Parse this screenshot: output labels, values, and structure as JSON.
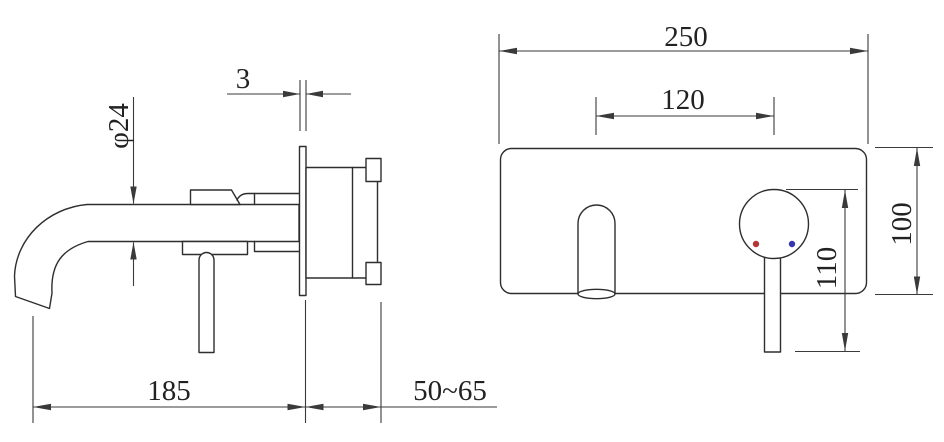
{
  "dimensions": {
    "side_view": {
      "spout_diameter": "φ24",
      "faceplate_thickness": "3",
      "spout_reach": "185",
      "wall_depth_range": "50~65"
    },
    "front_view": {
      "faceplate_width": "250",
      "spout_to_handle_distance": "120",
      "faceplate_height": "100",
      "handle_length": "110"
    }
  },
  "indicator_dots": {
    "hot_color": "#b23636",
    "cold_color": "#3636b2"
  },
  "line_color": "#2e2e2e"
}
